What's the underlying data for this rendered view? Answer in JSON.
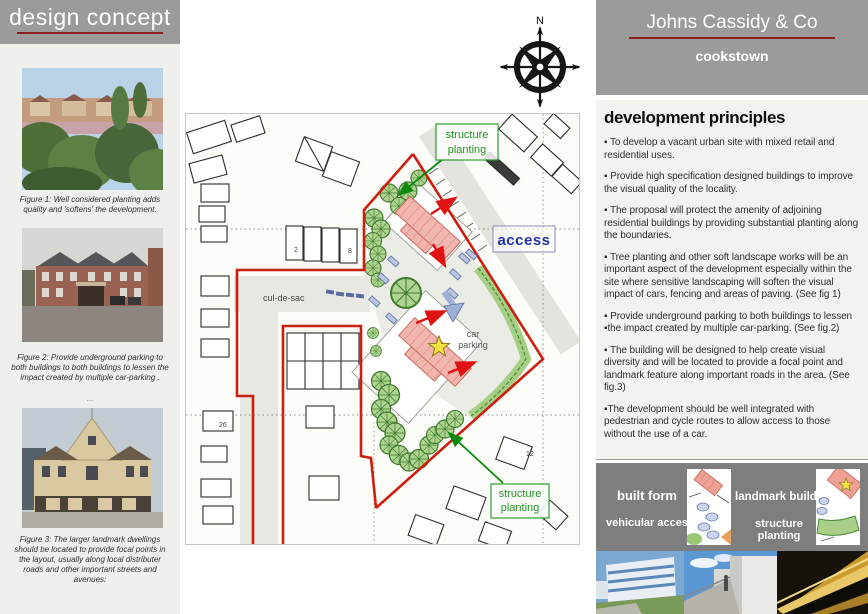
{
  "left_panel": {
    "title": "design concept",
    "figure1_caption": "Figure 1: Well considered planting adds quality and 'softens' the development.",
    "figure2_caption": "Figure 2: Provide underground parking to both buildings to both buildings to lessen the impact created by multiple car-parking .",
    "figure2_note": "...",
    "figure3_caption": "Figure 3: The larger landmark dwellings should be located to provide focal points in the layout, usually along local distributer roads and other important streets and avenues:"
  },
  "right_panel": {
    "company": "Johns Cassidy & Co",
    "town": "cookstown",
    "principles_title": "development principles",
    "principles": [
      "▪ To develop a vacant urban site with mixed retail and residential uses.",
      "▪ Provide high specification designed buildings to improve the visual quality of the locality.",
      "▪ The proposal will protect the amenity of adjoining residential buildings by providing substantial planting along the boundaries.",
      "▪ Tree planting and other soft landscape works will be an important aspect of the development especially within the site where sensitive landscaping will soften the visual impact of cars, fencing and areas of paving. (See fig 1)",
      "▪ Provide underground parking to both buildings to lessen ▪the impact created by multiple car-parking. (See fig.2)",
      "▪ The building will be designed to help create visual diversity and will be located to provide a focal point and landmark feature along important roads in the area. (See fig.3)",
      "▪The development should be well integrated with pedestrian and cycle routes to allow access to those without the use of a car."
    ],
    "legend": {
      "built_form": "built form",
      "vehicular_access": "vehicular access",
      "landmark_building": "landmark building",
      "structure_planting": "structure planting"
    }
  },
  "map": {
    "compass": "N",
    "structure_line1": "structure",
    "structure_line2": "planting",
    "access": "access",
    "cul_de_sac": "cul-de-sac",
    "car_line1": "car",
    "car_line2": "parking",
    "parcels": [
      "2",
      "8",
      "26",
      "12"
    ]
  }
}
